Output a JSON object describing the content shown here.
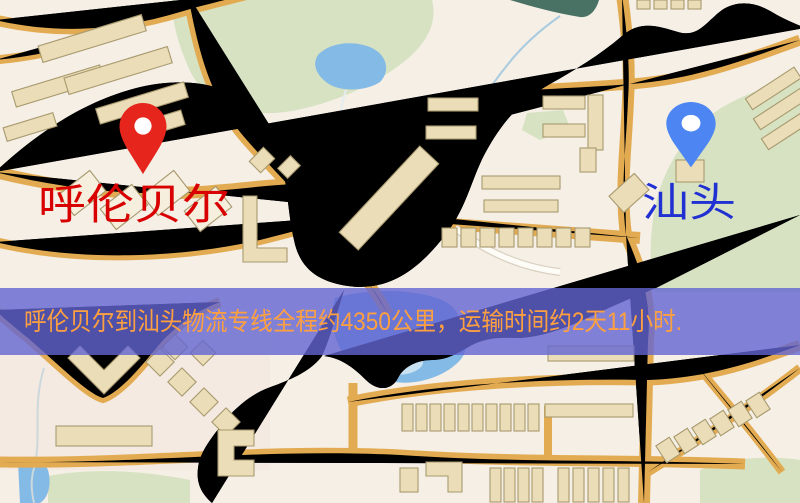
{
  "map": {
    "banner": {
      "text": "呼伦贝尔到汕头物流专线全程约4350公里，运输时间约2天11小时."
    },
    "origin": {
      "label": "呼伦贝尔"
    },
    "destination": {
      "label": "汕头"
    },
    "colors": {
      "bg": "#f5efe6",
      "park": "#d6e2c1",
      "parkDark": "#4a7264",
      "water": "#84bae6",
      "waterLight": "#c9e2f2",
      "road": "#f7d97b",
      "roadCasing": "#e3ab51",
      "building": "#eaddb7",
      "buildingStroke": "#a8996e",
      "railway": "#22222a",
      "stream": "#cdd8dc",
      "bannerBg": "rgba(99,101,210,0.8)",
      "bannerText": "#ffa040",
      "labelRed": "#d80000",
      "labelBlue": "#2130d2",
      "pinRed": "#e6251c",
      "pinBlue": "#4d86f2"
    }
  }
}
